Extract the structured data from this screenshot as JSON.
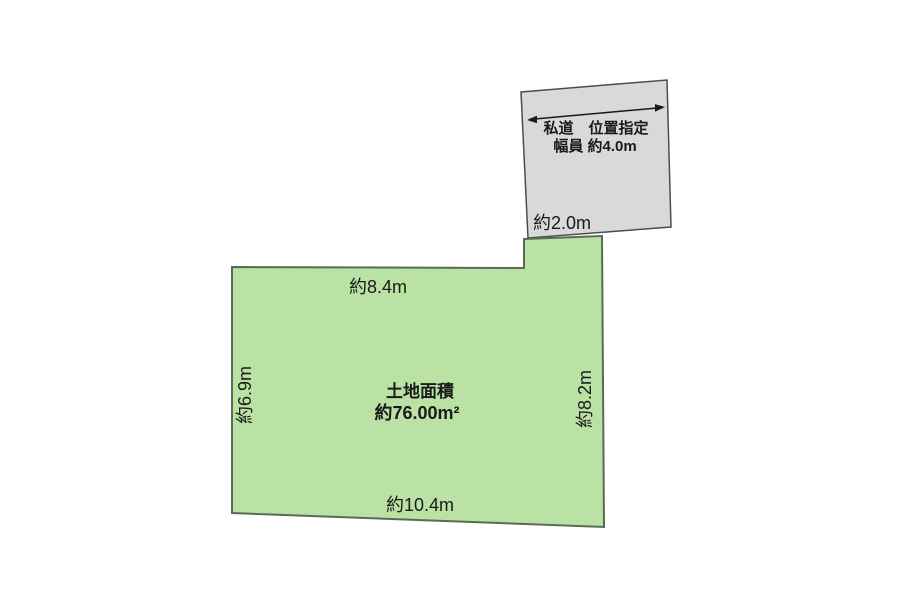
{
  "page": {
    "background": "#ffffff",
    "description": "Land plot layout diagram"
  },
  "colors": {
    "land_fill": "#b9e2a4",
    "land_stroke": "#5a6b55",
    "road_fill": "#d9d9d9",
    "road_stroke": "#4d4d4d",
    "text": "#1a1a1a"
  },
  "land": {
    "area_title": "土地面積",
    "area_value": "約76.00m²",
    "top_label": "約8.4m",
    "left_label": "約6.9m",
    "right_label": "約8.2m",
    "bottom_label": "約10.4m",
    "setback_label": "約2.0m"
  },
  "road": {
    "line1": "私道　位置指定",
    "line2": "幅員 約4.0m",
    "width_value": "約4.0m"
  }
}
